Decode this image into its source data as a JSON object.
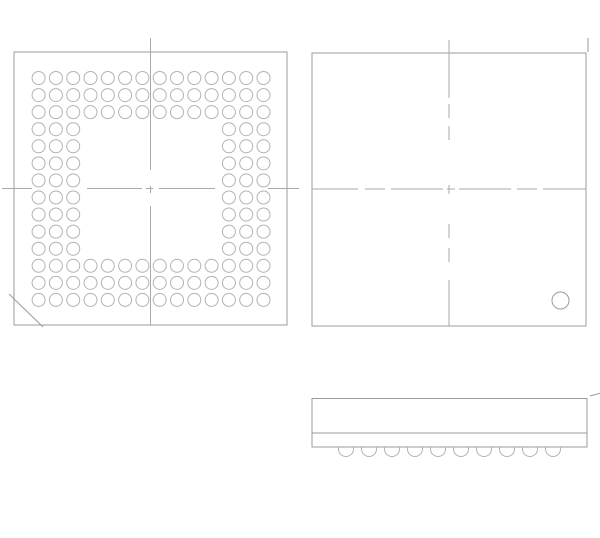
{
  "canvas": {
    "width": 600,
    "height": 538,
    "background": "#ffffff"
  },
  "colors": {
    "outline": "#9b9b9b",
    "centerline": "#aaaaaa",
    "ball": "#b3b3b3"
  },
  "bottom_view": {
    "outline": {
      "x": 14,
      "y": 52,
      "w": 273,
      "h": 273
    },
    "ball_grid": {
      "rows": 14,
      "cols": 14,
      "perimeter_depth": 3,
      "first_cx": 38.6,
      "first_cy": 78,
      "pitch_x": 17.3,
      "pitch_y": 17.07,
      "ball_r": 6.5,
      "total_balls": 132
    },
    "v_centerline": {
      "x": 150.5,
      "segments": [
        [
          38,
          170
        ],
        [
          186,
          193
        ],
        [
          206,
          325
        ]
      ]
    },
    "h_centerline": {
      "y": 188.5,
      "segments": [
        [
          2,
          32
        ],
        [
          87,
          142
        ],
        [
          146,
          153
        ],
        [
          159,
          215
        ],
        [
          268,
          299
        ]
      ]
    },
    "chamfer": [
      9,
      294,
      43,
      327
    ]
  },
  "top_view": {
    "outline": {
      "x": 312,
      "y": 53,
      "w": 274,
      "h": 273
    },
    "v_centerline": {
      "x": 449,
      "segments": [
        [
          40,
          98
        ],
        [
          104,
          118
        ],
        [
          126,
          140
        ],
        [
          185,
          194
        ],
        [
          224,
          238
        ],
        [
          248,
          262
        ],
        [
          280,
          326
        ]
      ]
    },
    "h_centerline": {
      "y": 189,
      "segments": [
        [
          312,
          358
        ],
        [
          365,
          385
        ],
        [
          391,
          443
        ],
        [
          447,
          455
        ],
        [
          459,
          511
        ],
        [
          517,
          537
        ],
        [
          543,
          586
        ]
      ]
    },
    "pin1_circle": {
      "cx": 560.5,
      "cy": 300.5,
      "r": 8.5
    },
    "corner_tick": [
      588,
      38,
      588,
      52
    ]
  },
  "side_view": {
    "body": {
      "x": 312,
      "y": 398.5,
      "w": 275,
      "h": 48.5
    },
    "seam_y": 433,
    "balls": {
      "count": 10,
      "first_cx": 346,
      "pitch": 23,
      "r": 7.5,
      "top_y": 447,
      "side_drop": 2
    },
    "tick": [
      590,
      396,
      601,
      393
    ]
  }
}
